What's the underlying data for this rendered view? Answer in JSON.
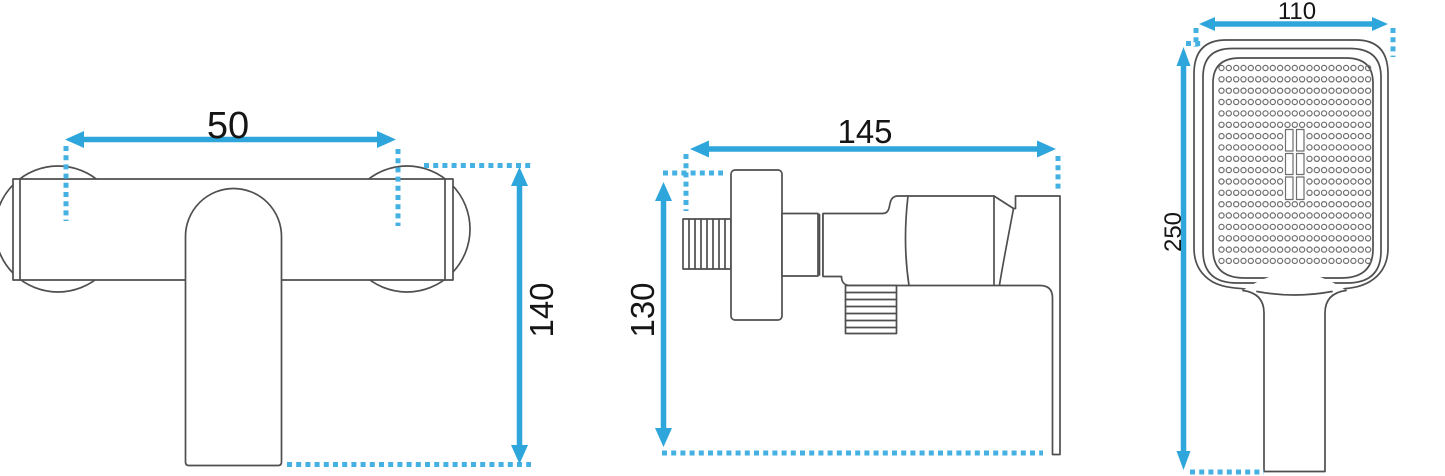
{
  "page": {
    "background": "#ffffff",
    "accent_blue": "#2ea6dc",
    "dot_blue": "#45b0e2",
    "line_color": "#4f4f4f",
    "nozzle_line_color": "#6f6f6f",
    "label_color": "#151515"
  },
  "views": {
    "front": {
      "width_mm": "50",
      "height_mm": "140"
    },
    "side": {
      "width_mm": "145",
      "height_mm": "130"
    },
    "hand_shower": {
      "width_mm": "110",
      "height_mm": "250"
    }
  }
}
